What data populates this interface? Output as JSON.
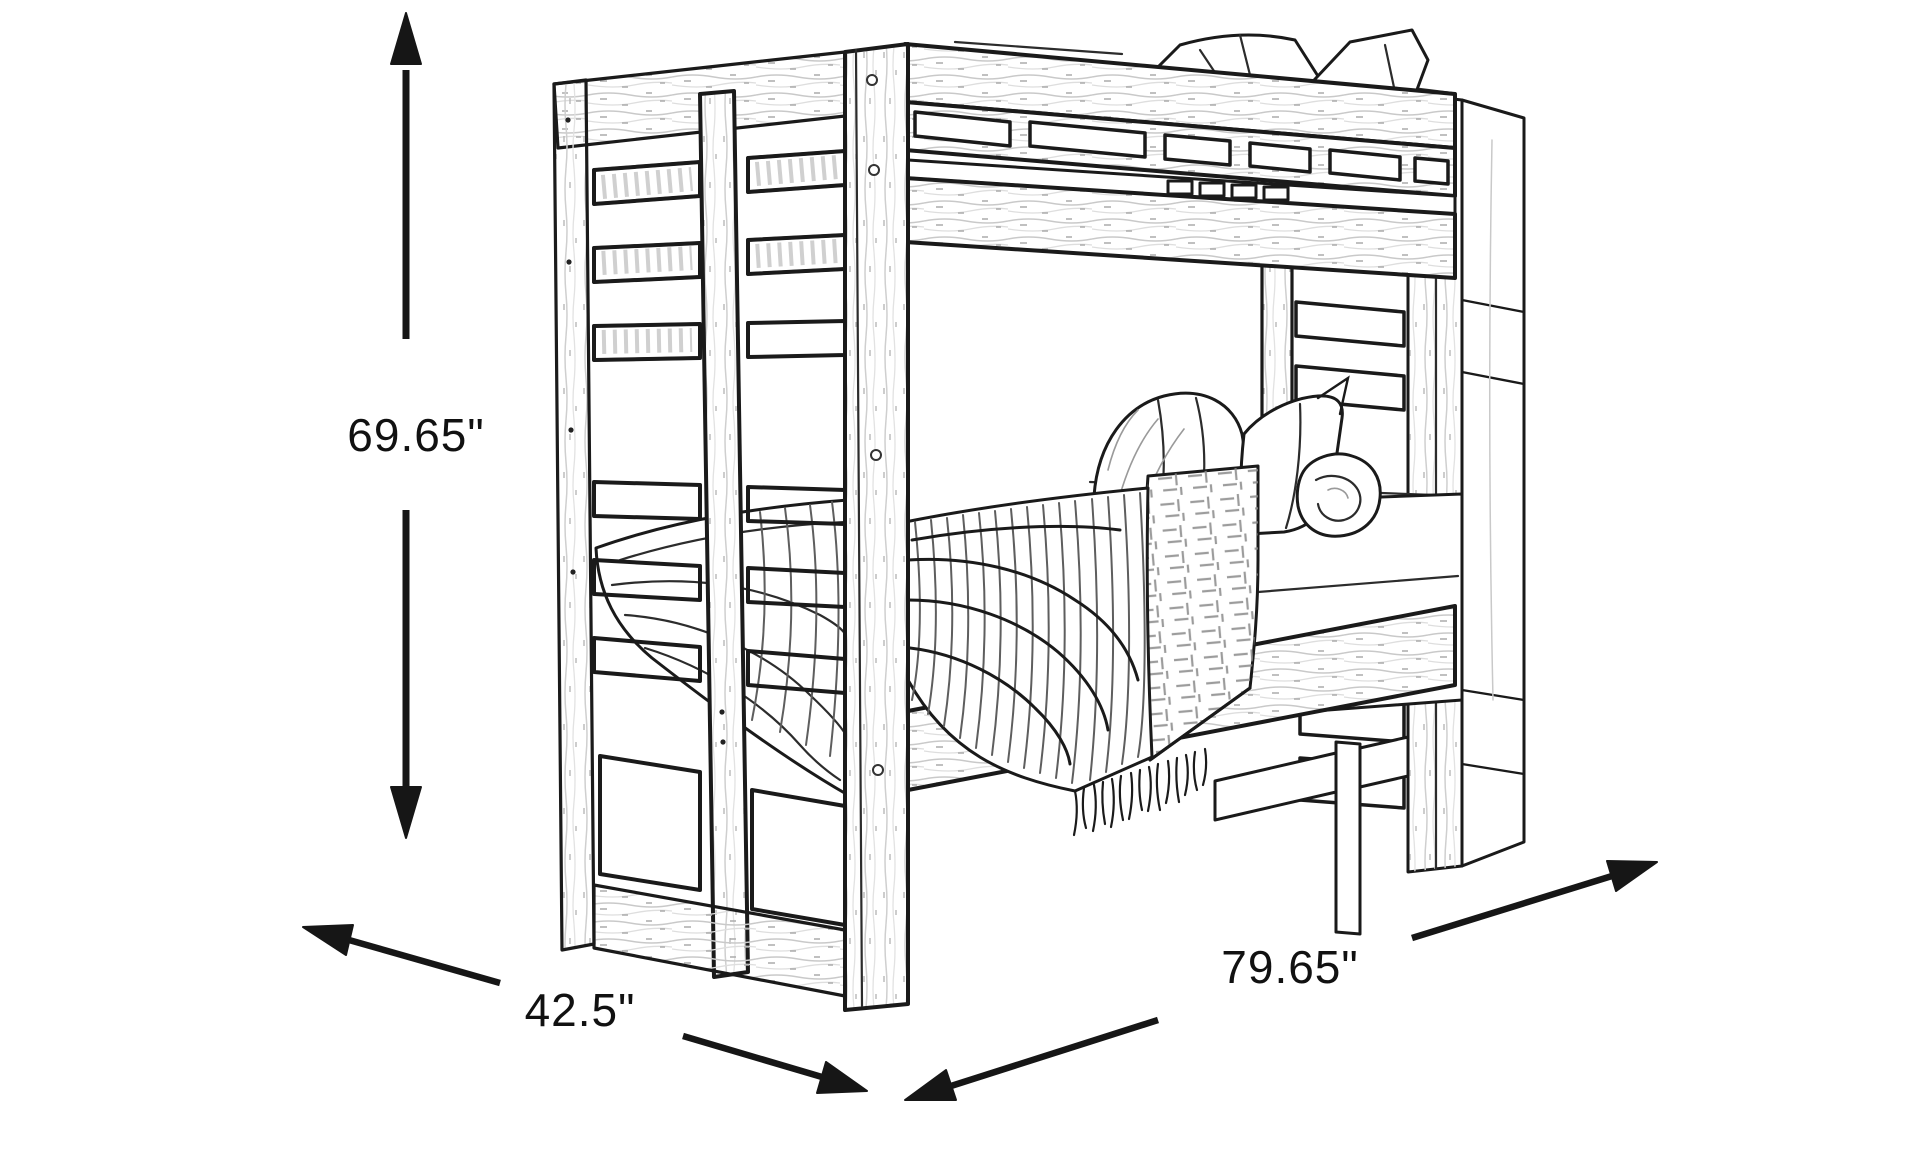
{
  "page": {
    "background": "#ffffff",
    "ink": "#1a1a1a"
  },
  "illustration": {
    "name": "bunk-bed-line-sketch"
  },
  "dimensions": {
    "height": {
      "label": "69.65\"",
      "value": 69.65
    },
    "depth": {
      "label": "42.5\"",
      "value": 42.5
    },
    "length": {
      "label": "79.65\"",
      "value": 79.65
    }
  }
}
